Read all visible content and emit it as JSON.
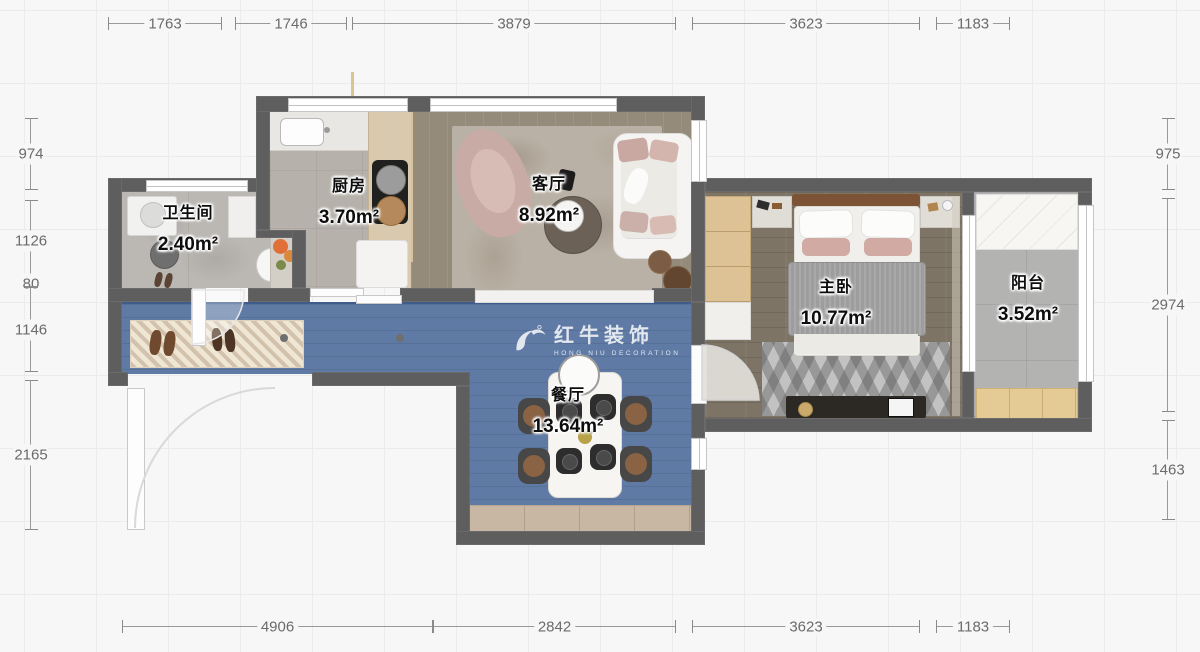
{
  "watermark": {
    "brand": "红牛装饰",
    "subtitle": "HONG NIU DECORATION",
    "reg": "®"
  },
  "rooms": {
    "bathroom": {
      "name": "卫生间",
      "area": "2.40m²"
    },
    "kitchen": {
      "name": "厨房",
      "area": "3.70m²"
    },
    "living": {
      "name": "客厅",
      "area": "8.92m²"
    },
    "dining": {
      "name": "餐厅",
      "area": "13.64m²"
    },
    "bedroom": {
      "name": "主卧",
      "area": "10.77m²"
    },
    "balcony": {
      "name": "阳台",
      "area": "3.52m²"
    }
  },
  "dimensions": {
    "top": [
      "1763",
      "1746",
      "3879",
      "3623",
      "1183"
    ],
    "bottom": [
      "4906",
      "2842",
      "3623",
      "1183"
    ],
    "left": [
      "974",
      "1126",
      "80",
      "1146",
      "2165"
    ],
    "right": [
      "975",
      "2974",
      "1463"
    ]
  },
  "colors": {
    "wall": "#5e5e5e",
    "corridor_floor": "#5e7aa5",
    "wood_floor": "#958b7b",
    "bedroom_floor": "#7e7466",
    "cabinet_wood": "#dcc295",
    "label_text": "#0d0d0d"
  }
}
